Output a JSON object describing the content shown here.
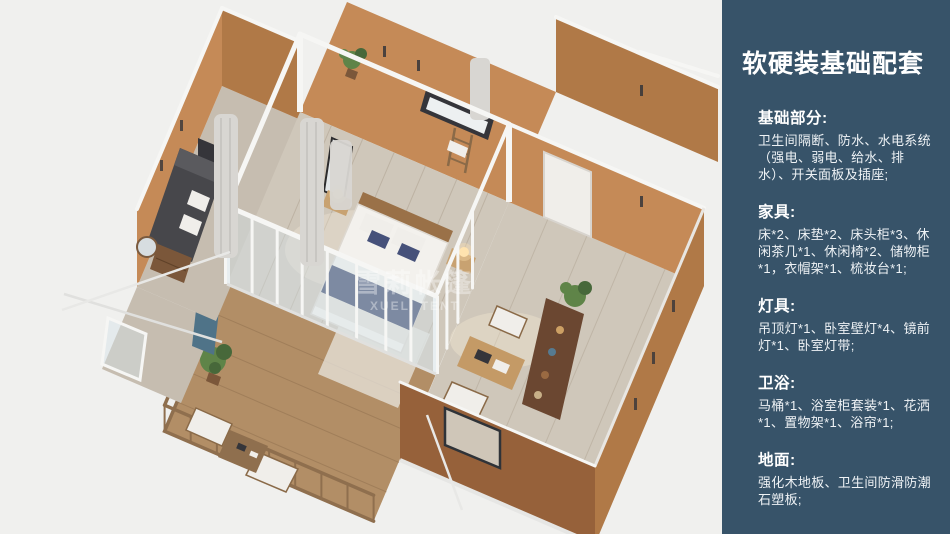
{
  "sidebar": {
    "title": "软硬装基础配套",
    "sections": [
      {
        "id": "basic",
        "heading": "基础部分:",
        "body": "卫生间隔断、防水、水电系统（强电、弱电、给水、排水）、开关面板及插座;"
      },
      {
        "id": "furniture",
        "heading": "家具:",
        "body": "床*2、床垫*2、床头柜*3、休闲茶几*1、休闲椅*2、储物柜*1，衣帽架*1、梳妆台*1;"
      },
      {
        "id": "lighting",
        "heading": "灯具:",
        "body": "吊顶灯*1、卧室壁灯*4、镜前灯*1、卧室灯带;"
      },
      {
        "id": "bath",
        "heading": "卫浴:",
        "body": "马桶*1、浴室柜套装*1、花洒*1、置物架*1、浴帘*1;"
      },
      {
        "id": "floor",
        "heading": "地面:",
        "body": "强化木地板、卫生间防滑防潮石塑板;"
      }
    ]
  },
  "render": {
    "watermark": {
      "line1": "雪莉帐篷",
      "line2": "XUELI TENT"
    }
  },
  "palette": {
    "sidebar_bg": "#375369",
    "sidebar_text": "#eef2f5",
    "bg": "#f0f0ee",
    "wall_lit": "#c58a57",
    "wall_mid": "#b07947",
    "wall_dark": "#96613a",
    "floor_wood": "#cfc7ba",
    "floor_plank": "#b9ae9e",
    "deck_wood": "#b28e66",
    "deck_dark": "#8f6f4e",
    "frame_white": "#f6f6f4",
    "curtain": "#d8d6d2",
    "sofa": "#47474b",
    "bed_white": "#f3f1ed",
    "blanket": "#3f4a6e",
    "headboard": "#9a7148",
    "wood_dark": "#7b573a",
    "shelf": "#6b4731",
    "plant": "#5f8448",
    "plant_dark": "#47683a",
    "lamp": "#ffe3b0",
    "teal_curtain": "#4f7388"
  }
}
